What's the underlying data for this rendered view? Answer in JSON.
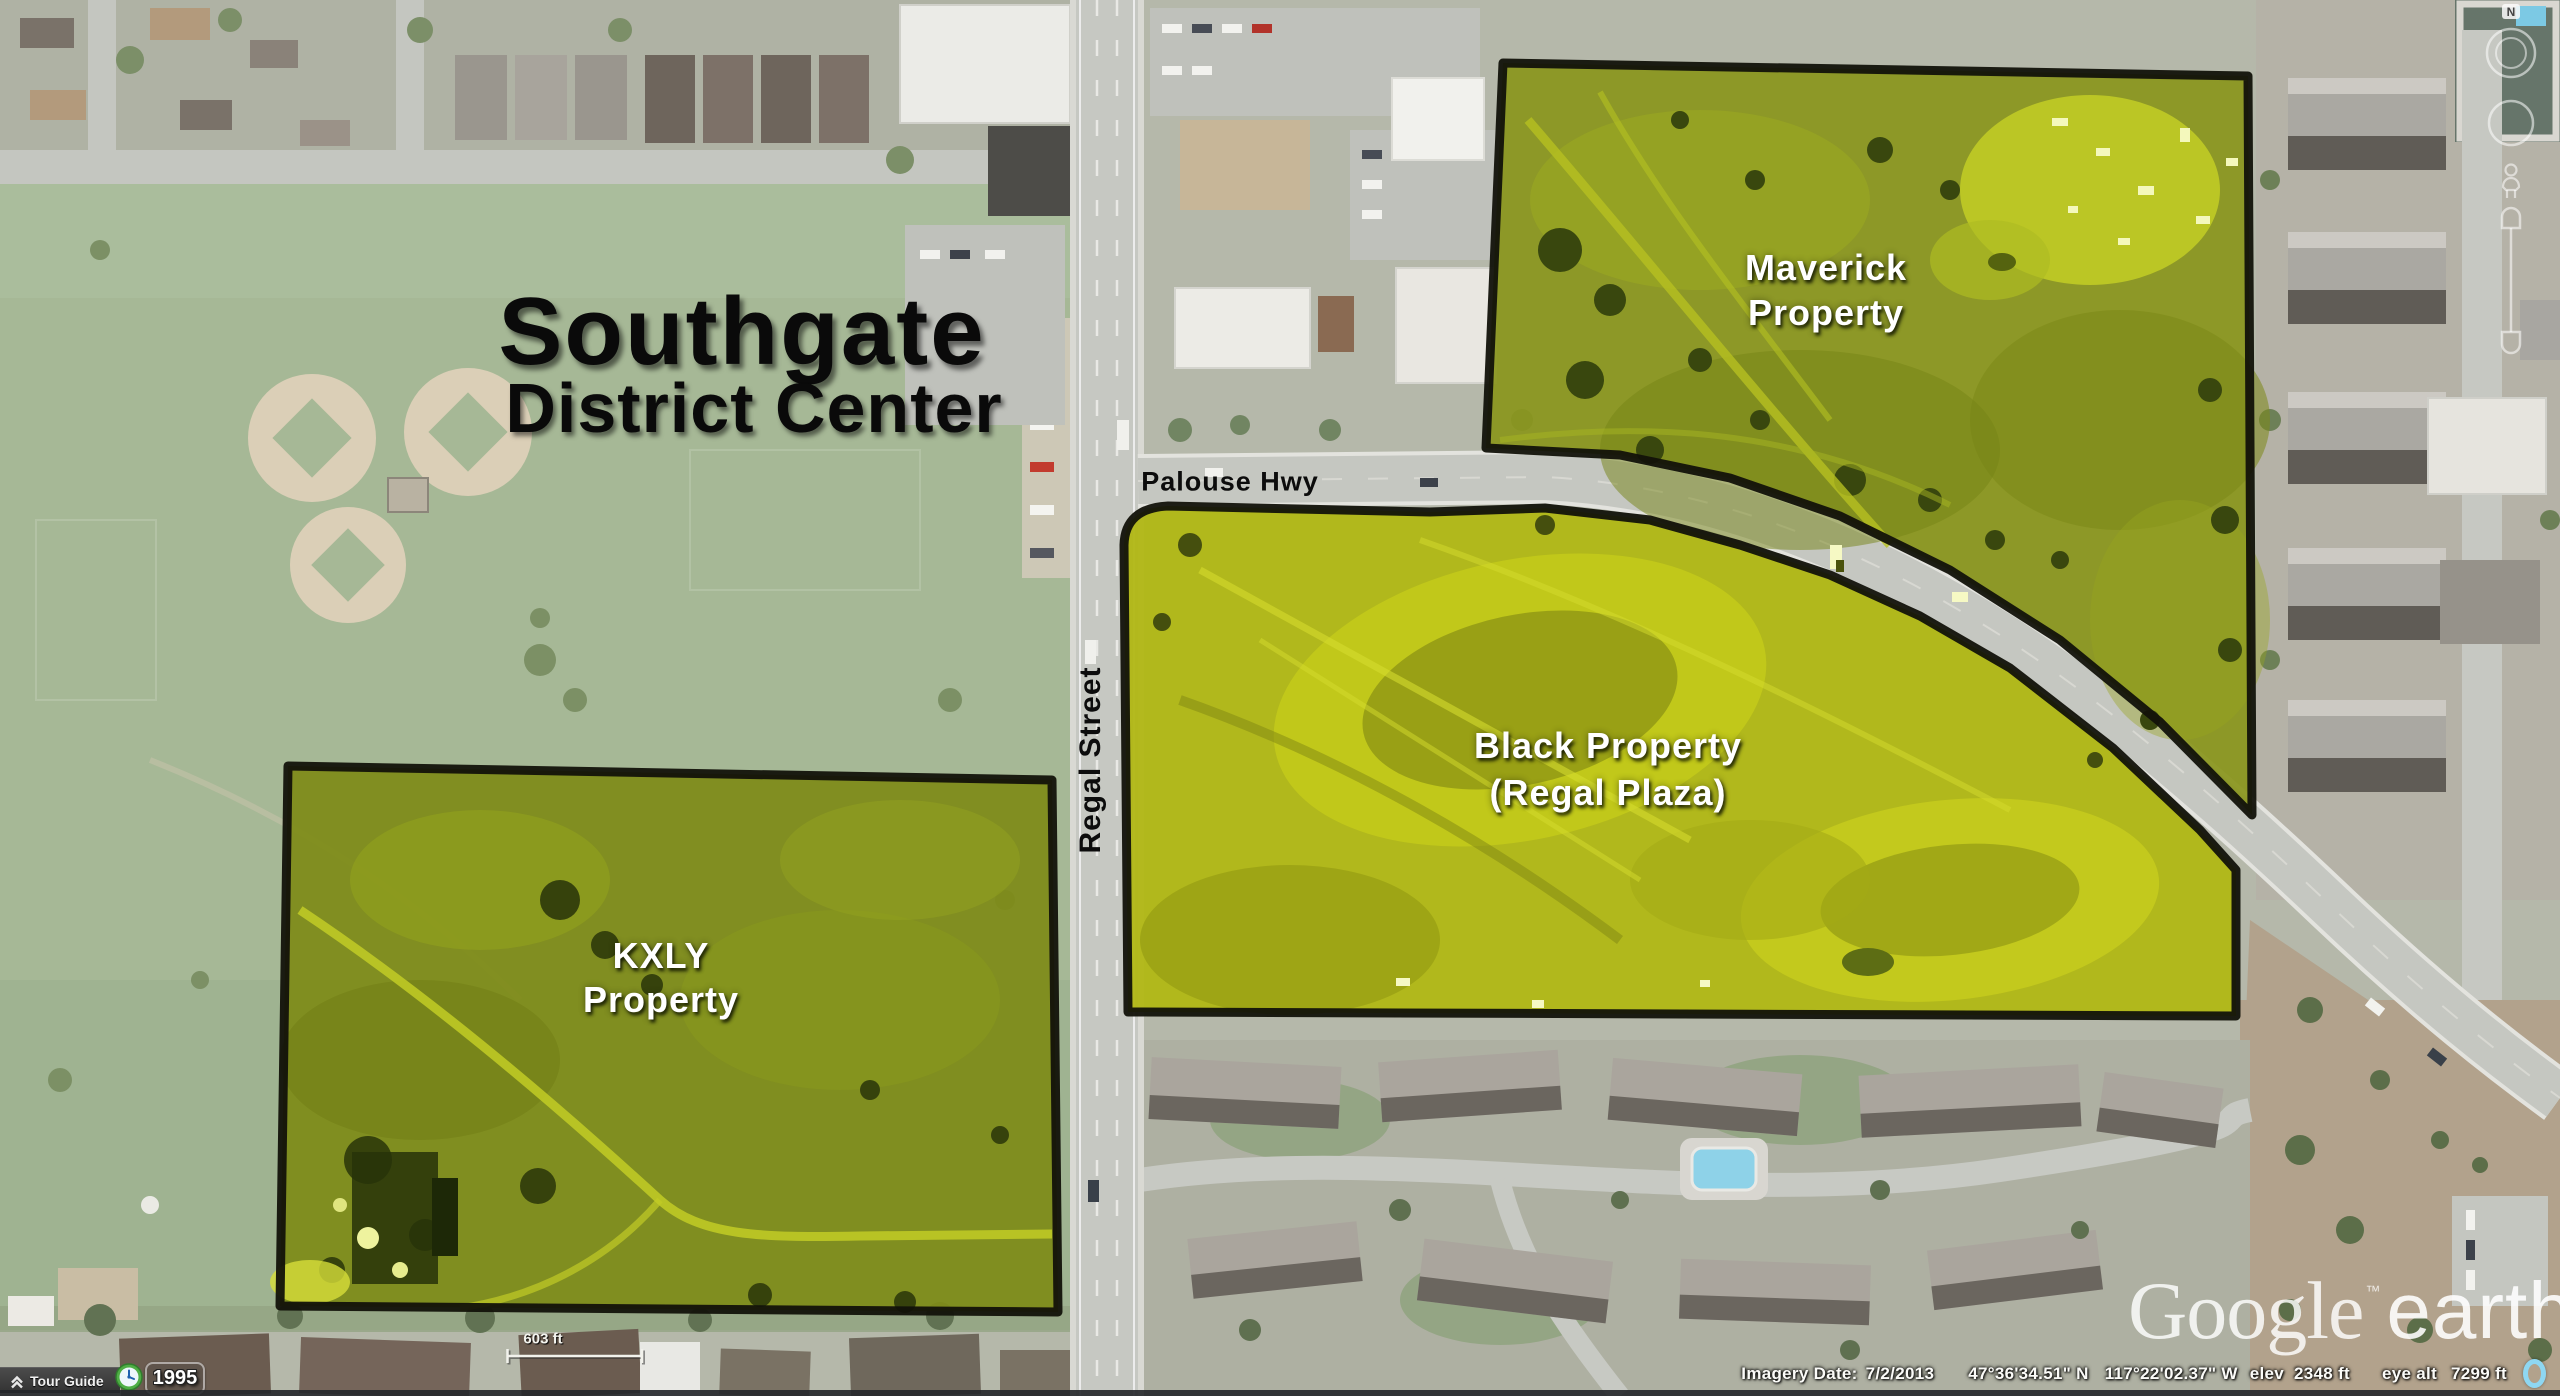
{
  "map_overlay": {
    "title": {
      "line1": "Southgate",
      "line2": "District Center"
    },
    "properties": [
      {
        "name": "Maverick Property",
        "line1": "Maverick",
        "line2": "Property"
      },
      {
        "name": "Black Property (Regal Plaza)",
        "line1": "Black Property",
        "line2": "(Regal Plaza)"
      },
      {
        "name": "KXLY Property",
        "line1": "KXLY",
        "line2": "Property"
      }
    ],
    "streets": [
      {
        "name": "Palouse Hwy"
      },
      {
        "name": "Regal Street"
      }
    ],
    "colors": {
      "highlight": "#b4ba14",
      "outline": "#121209",
      "streaming_indicator": "#8ed7f2"
    }
  },
  "scale_bar": {
    "label": "603 ft"
  },
  "watermark": {
    "brand": "Google",
    "tm": "™",
    "product": "earth"
  },
  "status_bar": {
    "imagery_date_label": "Imagery Date:",
    "imagery_date": "7/2/2013",
    "latitude": "47°36'34.51\" N",
    "longitude": "117°22'02.37\" W",
    "elev_label": "elev",
    "elevation": "2348 ft",
    "eye_alt_label": "eye alt",
    "eye_altitude": "7299 ft"
  },
  "tour_guide": {
    "label": "Tour Guide"
  },
  "time_slider": {
    "year": "1995"
  },
  "nav_controls": {
    "north_label": "N"
  }
}
